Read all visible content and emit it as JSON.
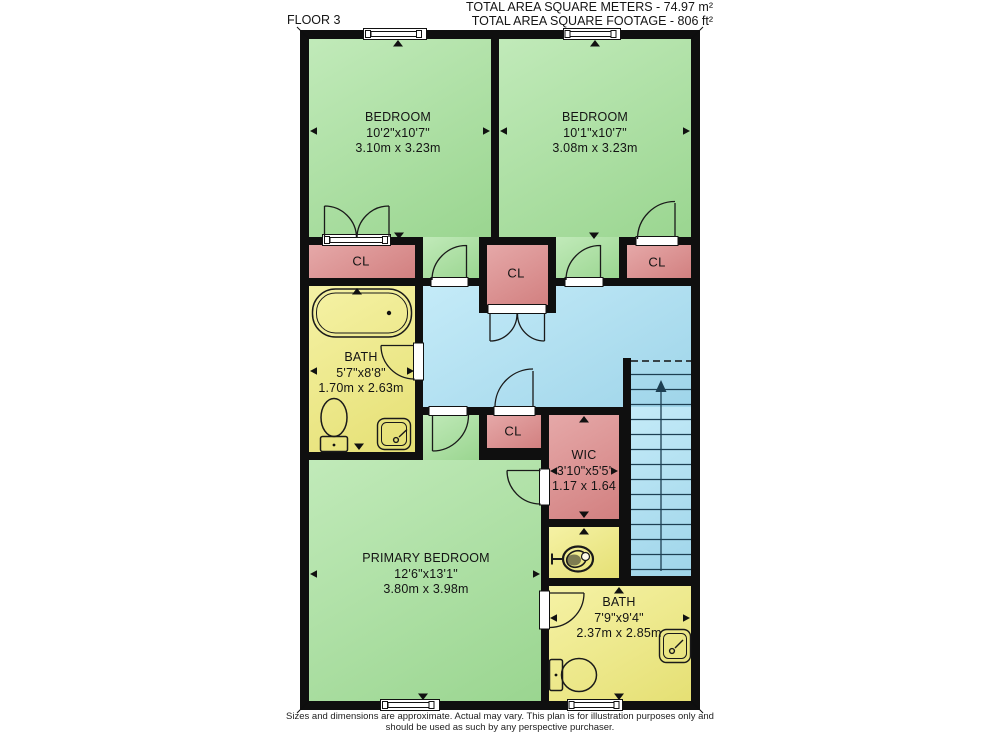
{
  "header": {
    "floor_label": "FLOOR 3",
    "total_area_metric": "TOTAL AREA SQUARE METERS - 74.97 m²",
    "total_area_imperial": "TOTAL AREA SQUARE FOOTAGE - 806 ft²"
  },
  "rooms": {
    "bedroom_left": {
      "name": "BEDROOM",
      "dims_imperial": "10'2\"x10'7\"",
      "dims_metric": "3.10m x 3.23m"
    },
    "bedroom_right": {
      "name": "BEDROOM",
      "dims_imperial": "10'1\"x10'7\"",
      "dims_metric": "3.08m x 3.23m"
    },
    "bath_upper": {
      "name": "BATH",
      "dims_imperial": "5'7\"x8'8\"",
      "dims_metric": "1.70m x 2.63m"
    },
    "closet_left": {
      "name": "CL"
    },
    "closet_middle": {
      "name": "CL"
    },
    "closet_right": {
      "name": "CL"
    },
    "closet_hall": {
      "name": "CL"
    },
    "wic": {
      "name": "WIC",
      "dims_imperial": "3'10\"x5'5'",
      "dims_metric": "1.17 x 1.64"
    },
    "primary_bedroom": {
      "name": "PRIMARY BEDROOM",
      "dims_imperial": "12'6\"x13'1\"",
      "dims_metric": "3.80m x 3.98m"
    },
    "bath_lower": {
      "name": "BATH",
      "dims_imperial": "7'9\"x9'4\"",
      "dims_metric": "2.37m x 2.85m"
    }
  },
  "footer": {
    "line1": "Sizes and dimensions are approximate. Actual may vary. This plan is for illustration purposes only and",
    "line2": "should be used as such by any perspective purchaser."
  },
  "colors": {
    "room-green": "#a6e19b",
    "closet-pink": "#dd8b8b",
    "bath-yellow": "#f1ec7e",
    "hall-blue": "#abe2f5",
    "wall-black": "#0f0f0f"
  }
}
